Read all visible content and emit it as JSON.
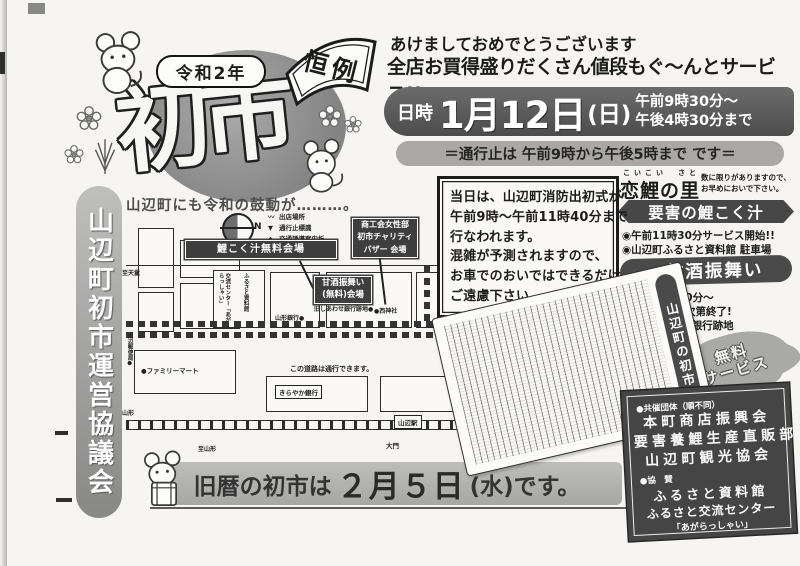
{
  "colors": {
    "ink": "#1c1c1c",
    "paper": "#f6f5f1",
    "dark_banner": "#4c4c4c",
    "mid_gray": "#a9a8a5",
    "circle_gray": "#8a8a8a"
  },
  "header": {
    "year": "令和2年",
    "badge": "恒例",
    "title": "初市",
    "caption": "山辺町にも令和の鼓動が………。"
  },
  "greeting": {
    "line1": "あけましておめでとうございます",
    "line2": "全店お買得盛りだくさん値段もぐ〜んとサービス!!"
  },
  "datetime": {
    "label": "日時",
    "date": "1月12日",
    "day": "(日)",
    "time1": "午前9時30分〜",
    "time2": "午後4時30分まで"
  },
  "closure": {
    "text": "＝通行止は 午前9時から午後5時まで です＝"
  },
  "organizer": {
    "text": "山辺町初市運営協議会"
  },
  "notice": {
    "lines": [
      "当日は、山辺町消防出初式が",
      "午前9時〜午前11時40分まで",
      "行なわれます。",
      "混雑が予測されますので、",
      "お車でのおいではできるだけ",
      "ご遠慮下さい。"
    ]
  },
  "map": {
    "compass": "N",
    "legend": [
      {
        "symbol": "〰",
        "label": "出店場所"
      },
      {
        "symbol": "▼",
        "label": "通行止標識"
      },
      {
        "symbol": "◆",
        "label": "交通誘導案内板"
      }
    ],
    "venues": {
      "koikoku": "鯉こく汁無料会場",
      "bazaar1": "商工会女性部",
      "bazaar2": "初市チャリティ",
      "bazaar3": "バザー 会場",
      "amazake1": "甘酒振舞い",
      "amazake2": "(無料)会場"
    },
    "labels": {
      "tendo": "至天童",
      "post": "山辺郵便局●",
      "yamagata_bank": "山形銀行●",
      "shiawase": "旧しあわせ銀行跡地●",
      "nishi": "●西神社",
      "furusato": "ふるさと資料館",
      "kouryu": "交流センター「あがらっしゃい」",
      "kirayaka": "きらやか銀行",
      "familymart": "●ファミリーマート",
      "passable": "この道路は通行できます。",
      "station": "山辺駅",
      "daimon": "大門",
      "sagae": "至寒河江",
      "nakayama": "至中山",
      "yamagata_rail": "至山形",
      "yamagata_st": "至山形"
    }
  },
  "right_panel": {
    "furigana": "こいこい　さと",
    "koi_title": "恋鯉の里",
    "note1": "数に限りがありますので、",
    "note2": "お早めにおいで下さい。",
    "koikoku_banner": "要害の鯉こく汁",
    "koikoku_item1": "◉午前11時30分サービス開始!!",
    "koikoku_item2": "◉山辺町ふるさと資料館 駐車場",
    "amazake_banner": "●甘酒振舞い",
    "amazake_item1": "◉午前9時30分〜",
    "amazake_item2": "無くなり次第終了!",
    "amazake_item3": "◉旧しあわせ銀行跡地",
    "stamp_line1": "無料",
    "stamp_line2": "サービス"
  },
  "article": {
    "title": "山辺町の初市"
  },
  "bottom_banner": {
    "prefix": "旧暦の初市は",
    "date": "２月５日",
    "suffix": "(水)です。"
  },
  "sponsors": {
    "heading1": "●共催団体（順不同）",
    "group1": "本町商店振興会",
    "group2": "要害養鯉生産直販部",
    "group3": "山辺町観光協会",
    "heading2": "●協　賛",
    "supporter1": "ふるさと資料館",
    "supporter2": "ふるさと交流センター",
    "supporter3": "「あがらっしゃい」"
  }
}
